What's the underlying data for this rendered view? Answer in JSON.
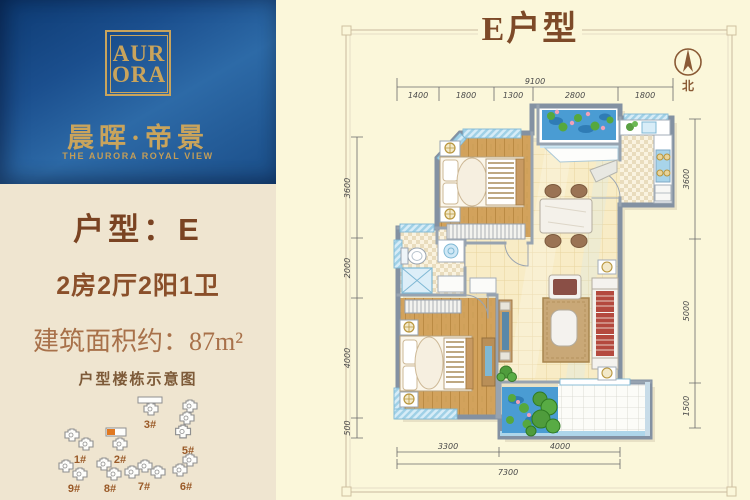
{
  "brand": {
    "monogram_top": "AUR",
    "monogram_bottom": "ORA",
    "name_cn": "晨晖·帝景",
    "name_en": "THE AURORA ROYAL VIEW"
  },
  "unit": {
    "type_label": "户型：E",
    "layout": "2房2厅2阳1卫",
    "area_label": "建筑面积约：87m²",
    "diagram_title": "户型楼栋示意图"
  },
  "buildings": {
    "items": [
      {
        "label": "1#",
        "highlighted": false
      },
      {
        "label": "2#",
        "highlighted": true
      },
      {
        "label": "3#",
        "highlighted": false
      },
      {
        "label": "5#",
        "highlighted": false
      },
      {
        "label": "6#",
        "highlighted": false
      },
      {
        "label": "7#",
        "highlighted": false
      },
      {
        "label": "8#",
        "highlighted": false
      },
      {
        "label": "9#",
        "highlighted": false
      }
    ]
  },
  "plan": {
    "title": "E户型",
    "north_label": "北",
    "dims": {
      "top": {
        "total": "9100",
        "segments": [
          "1400",
          "1800",
          "1300",
          "2800",
          "1800"
        ]
      },
      "left": {
        "segments": [
          "3600",
          "2000",
          "4000",
          "500"
        ]
      },
      "right": {
        "segments": [
          "3600",
          "5000",
          "1500"
        ]
      },
      "bottom": {
        "segments": [
          "3300",
          "4000"
        ],
        "total": "7300"
      }
    }
  },
  "colors": {
    "card_blue": "#1c5293",
    "gold": "#c9a45c",
    "text_brown": "#7a4322",
    "area_brown": "#a8714a",
    "left_bg": "#efe5d0",
    "panel_bg": "#fbf7da",
    "water_blue": "#4a9cd3"
  }
}
